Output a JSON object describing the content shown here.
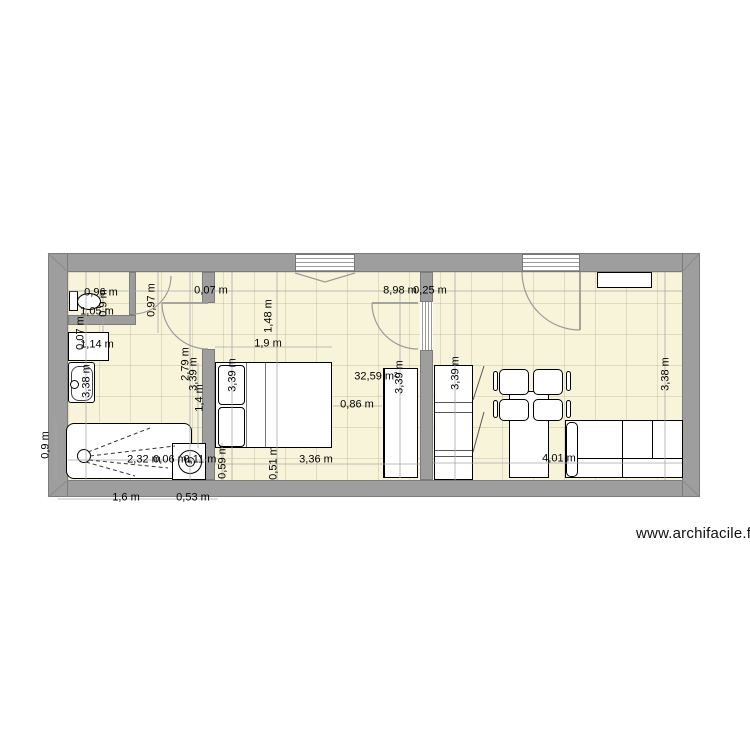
{
  "watermark": {
    "text": "www.archifacile.fr"
  },
  "plan": {
    "area_label": "32,59 m²",
    "colors": {
      "floor": "#f8f4da",
      "wall": "#9e9e9e",
      "furniture": "#ffffff",
      "dim_text": "#000000"
    },
    "fixtures": [
      "toilet",
      "vanity-cabinet",
      "washbasin",
      "shower",
      "washing-machine",
      "double-bed",
      "wardrobe",
      "closet",
      "wall-shelf",
      "dining-table",
      "dining-chair",
      "sofa",
      "door-swing",
      "window"
    ],
    "dimensions": [
      {
        "t": "0,96 m",
        "x": 101,
        "y": 293,
        "r": 0
      },
      {
        "t": "0,9 m",
        "x": 104,
        "y": 303,
        "r": 1
      },
      {
        "t": "1,05 m",
        "x": 97,
        "y": 312,
        "r": 0
      },
      {
        "t": "0,07 m",
        "x": 81,
        "y": 333,
        "r": 1
      },
      {
        "t": "1,14 m",
        "x": 97,
        "y": 345,
        "r": 0
      },
      {
        "t": "0,97 m",
        "x": 152,
        "y": 300,
        "r": 1
      },
      {
        "t": "3,38 m",
        "x": 87,
        "y": 381,
        "r": 1
      },
      {
        "t": "0,9 m",
        "x": 46,
        "y": 445,
        "r": 1
      },
      {
        "t": "0,07 m",
        "x": 211,
        "y": 291,
        "r": 0
      },
      {
        "t": "8,98 m",
        "x": 400,
        "y": 291,
        "r": 0
      },
      {
        "t": "0,25 m",
        "x": 430,
        "y": 291,
        "r": 0
      },
      {
        "t": "1,48 m",
        "x": 269,
        "y": 316,
        "r": 1
      },
      {
        "t": "1,9 m",
        "x": 268,
        "y": 344,
        "r": 0
      },
      {
        "t": "2,79 m",
        "x": 186,
        "y": 364,
        "r": 1
      },
      {
        "t": "3,39 m",
        "x": 194,
        "y": 374,
        "r": 1
      },
      {
        "t": "1,4 m",
        "x": 200,
        "y": 398,
        "r": 1
      },
      {
        "t": "3,39 m",
        "x": 233,
        "y": 375,
        "r": 1
      },
      {
        "t": "0,86 m",
        "x": 357,
        "y": 405,
        "r": 0
      },
      {
        "t": "32,59 m²",
        "x": 376,
        "y": 377,
        "r": 0
      },
      {
        "t": "3,39 m",
        "x": 400,
        "y": 377,
        "r": 1
      },
      {
        "t": "3,39 m",
        "x": 456,
        "y": 373,
        "r": 1
      },
      {
        "t": "3,38 m",
        "x": 666,
        "y": 374,
        "r": 1
      },
      {
        "t": "2,32 m",
        "x": 144,
        "y": 460,
        "r": 0
      },
      {
        "t": "0,06 m",
        "x": 170,
        "y": 460,
        "r": 0
      },
      {
        "t": "0,11 m",
        "x": 200,
        "y": 460,
        "r": 0
      },
      {
        "t": "0,59 m",
        "x": 223,
        "y": 462,
        "r": 1
      },
      {
        "t": "0,51 m",
        "x": 274,
        "y": 463,
        "r": 1
      },
      {
        "t": "3,36 m",
        "x": 316,
        "y": 460,
        "r": 0
      },
      {
        "t": "4,01 m",
        "x": 559,
        "y": 459,
        "r": 0
      },
      {
        "t": "1,6 m",
        "x": 126,
        "y": 498,
        "r": 0
      },
      {
        "t": "0,53 m",
        "x": 193,
        "y": 498,
        "r": 0
      }
    ]
  }
}
